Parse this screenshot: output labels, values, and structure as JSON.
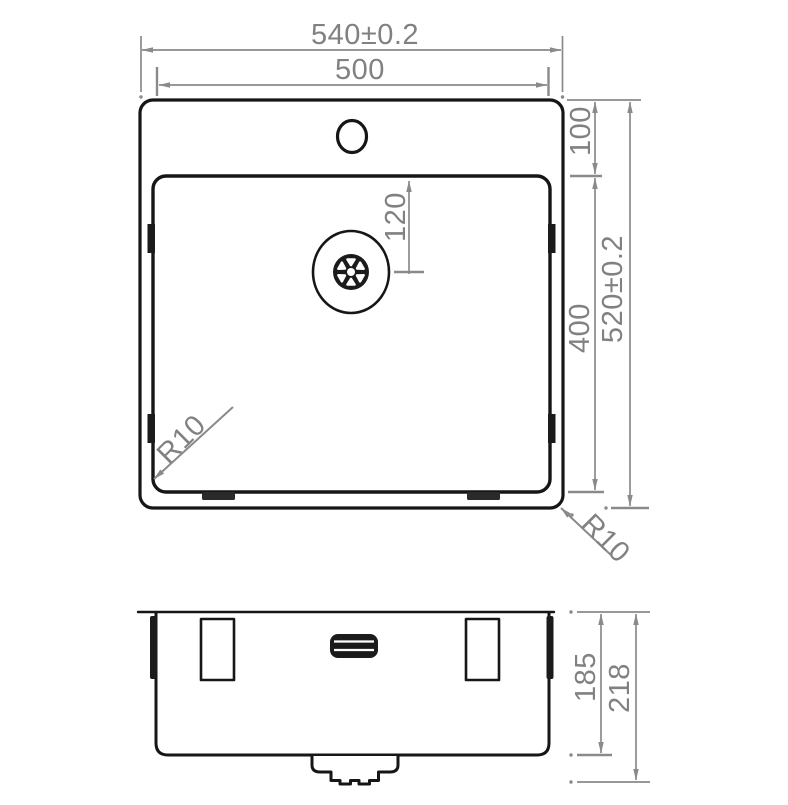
{
  "drawing": {
    "background": "#ffffff",
    "outline_color": "#161616",
    "dimension_color": "#8a8a8a",
    "dimension_text_color": "#818181"
  },
  "top_view": {
    "overall_width": "540±0.2",
    "inner_width": "500",
    "rim_depth": "100",
    "bowl_depth": "400",
    "overall_depth": "520±0.2",
    "drain_offset": "120",
    "bowl_corner_radius": "R10",
    "outer_corner_radius": "R10"
  },
  "front_view": {
    "bowl_height": "185",
    "overall_height": "218"
  }
}
